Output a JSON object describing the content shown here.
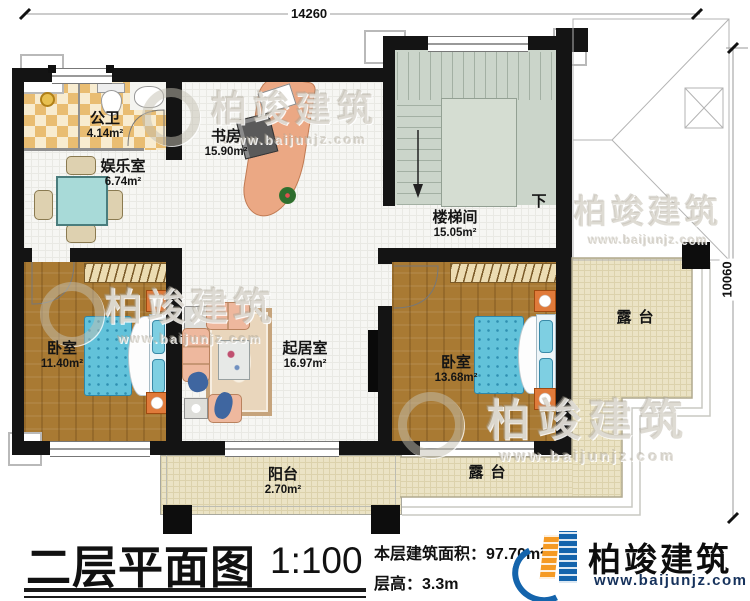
{
  "dimensions": {
    "top": "14260",
    "right": "10060"
  },
  "rooms": {
    "bath": {
      "name": "公卫",
      "area": "4.14m²"
    },
    "play": {
      "name": "娱乐室",
      "area": "6.74m²"
    },
    "study": {
      "name": "书房",
      "area": "15.90m²"
    },
    "stairwell": {
      "name": "楼梯间",
      "area": "15.05m²",
      "down": "下"
    },
    "bed_left": {
      "name": "卧室",
      "area": "11.40m²"
    },
    "living": {
      "name": "起居室",
      "area": "16.97m²"
    },
    "bed_right": {
      "name": "卧室",
      "area": "13.68m²"
    },
    "balcony": {
      "name": "阳台",
      "area": "2.70m²"
    },
    "terrace_right": {
      "name": "露台"
    },
    "terrace_bottom": {
      "name": "露台"
    }
  },
  "title_block": {
    "title": "二层平面图",
    "scale": "1:100",
    "area_label": "本层建筑面积：",
    "area_value": "97.70m²",
    "floor_height_label": "层高：",
    "floor_height_value": "3.3m"
  },
  "brand": {
    "name": "柏竣建筑",
    "website": "www.baijunjz.com"
  },
  "watermark": {
    "name": "柏竣建筑",
    "website": "www.baijunjz.com"
  },
  "icons": {
    "brand_logo": "building-swoosh-logo",
    "stair_arrow": "down-arrow"
  },
  "colors": {
    "wall": "#141414",
    "wood_floor": "#a97a33",
    "bath_tile": "#e9bd72",
    "stair_floor": "#cbd5ca",
    "terrace_floor": "#ebe3c5",
    "bed": "#62c2da",
    "brand_blue": "#1464ac",
    "brand_orange": "#f59a23"
  }
}
